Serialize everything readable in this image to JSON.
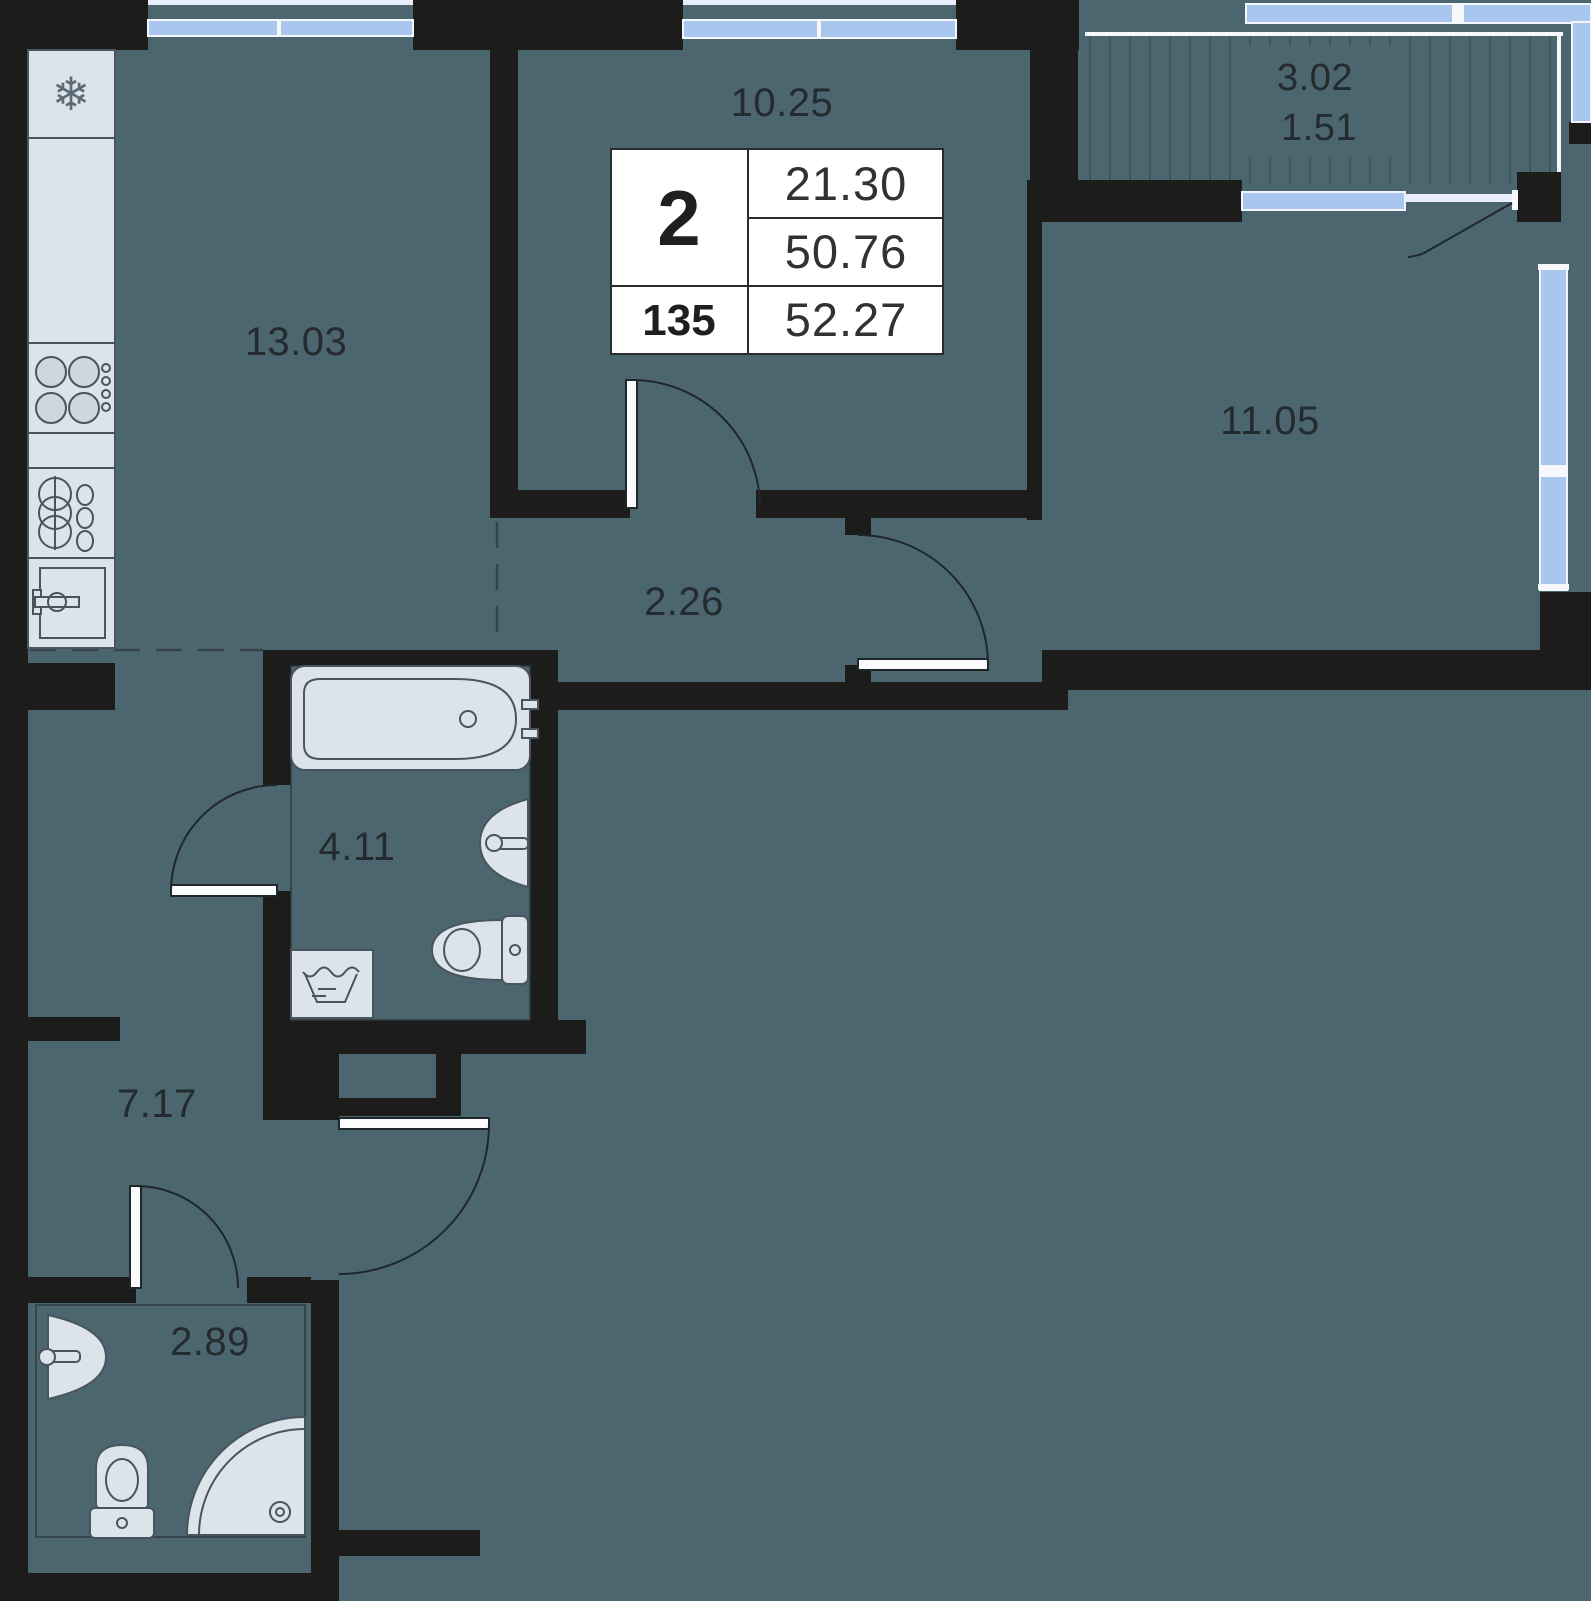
{
  "plan": {
    "title": "apartment-floor-plan",
    "info_card": {
      "rooms_count": "2",
      "apartment_number": "135",
      "living_area_m2": "21.30",
      "area_without_balcony_m2": "50.76",
      "total_area_m2": "52.27"
    },
    "rooms": [
      {
        "name": "kitchen",
        "area": "13.03"
      },
      {
        "name": "living-room",
        "area": "10.25"
      },
      {
        "name": "balcony",
        "area": "3.02",
        "area_reduced": "1.51"
      },
      {
        "name": "bedroom",
        "area": "11.05"
      },
      {
        "name": "hallway",
        "area": "2.26"
      },
      {
        "name": "bathroom",
        "area": "4.11"
      },
      {
        "name": "corridor",
        "area": "7.17"
      },
      {
        "name": "wc",
        "area": "2.89"
      }
    ],
    "icons": {
      "fridge_glyph": "❄"
    },
    "colors": {
      "floor": "#4c6670",
      "wall": "#1c1c1b",
      "window": "#a9c6ef",
      "fixture_fill": "#dce3ea",
      "fixture_stroke": "#49545c",
      "card_background": "#ffffff",
      "text": "#242b2e"
    }
  }
}
